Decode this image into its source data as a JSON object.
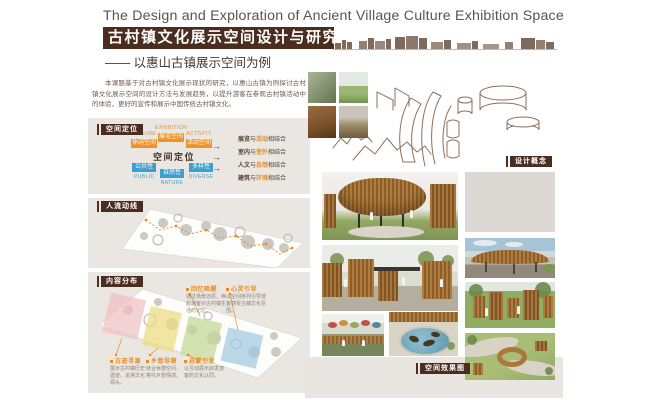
{
  "header": {
    "title_en": "The Design and Exploration of Ancient Village Culture Exhibition Space",
    "title_zh": "古村镇文化展示空间设计与研究",
    "subtitle": "—— 以惠山古镇展示空间为例",
    "intro": "本课题基于对古村镇文化展示现状的研究，以惠山古镇为例探讨古村镇文化展示空间的设计方法与发展趋势，以提升游客在参观古村镇活动中的体验，更好的宣传和展示中国传统古村镇文化。"
  },
  "positioning": {
    "badge": "空间定位",
    "center_label": "空间定位",
    "arrow": "→",
    "top_items": [
      {
        "en": "LEISURE",
        "zh": "休闲空间"
      },
      {
        "en": "EXHIBITION",
        "zh": "展览空间"
      },
      {
        "en": "ACTIVITY",
        "zh": "活动空间"
      }
    ],
    "bottom_items": [
      {
        "en": "PUBLIC",
        "zh": "公共性"
      },
      {
        "en": "NATURE",
        "zh": "自然性"
      },
      {
        "en": "DIVERSE",
        "zh": "多样性"
      }
    ],
    "principles": [
      {
        "left": "展览",
        "mid": "与",
        "right": "活动",
        "tail": "相结合"
      },
      {
        "left": "室内",
        "mid": "与",
        "right": "室外",
        "tail": "相结合"
      },
      {
        "left": "人文",
        "mid": "与",
        "right": "自然",
        "tail": "相结合"
      },
      {
        "left": "建筑",
        "mid": "与",
        "right": "环境",
        "tail": "相结合"
      }
    ]
  },
  "circulation": {
    "badge": "人流动线"
  },
  "distribution": {
    "badge": "内容分布",
    "callouts": [
      {
        "title": "回忆唤醒",
        "desc": "通过场景还原，唤起游客对古村镇生活的记忆。"
      },
      {
        "title": "心灵引导",
        "desc": "以空间序列引导游客感受古镇文化氛围。"
      },
      {
        "title": "古迹寻源",
        "desc": "展示古村镇历史遗迹，追溯文化源头。"
      },
      {
        "title": "乡愁导憩",
        "desc": "结合休憩空间，寄托乡愁情感。"
      },
      {
        "title": "启蒙引发",
        "desc": "以互动展示启发游客的文化认同。"
      }
    ]
  },
  "concept": {
    "badge": "设计概念"
  },
  "renderings": {
    "badge": "空间效果图"
  },
  "colors": {
    "brown_dark": "#4b2d20",
    "orange": "#ea8c1e",
    "blue": "#3ba0cd",
    "panel_beige": "#eae7e2",
    "sketch_brown": "#8b6f58"
  }
}
